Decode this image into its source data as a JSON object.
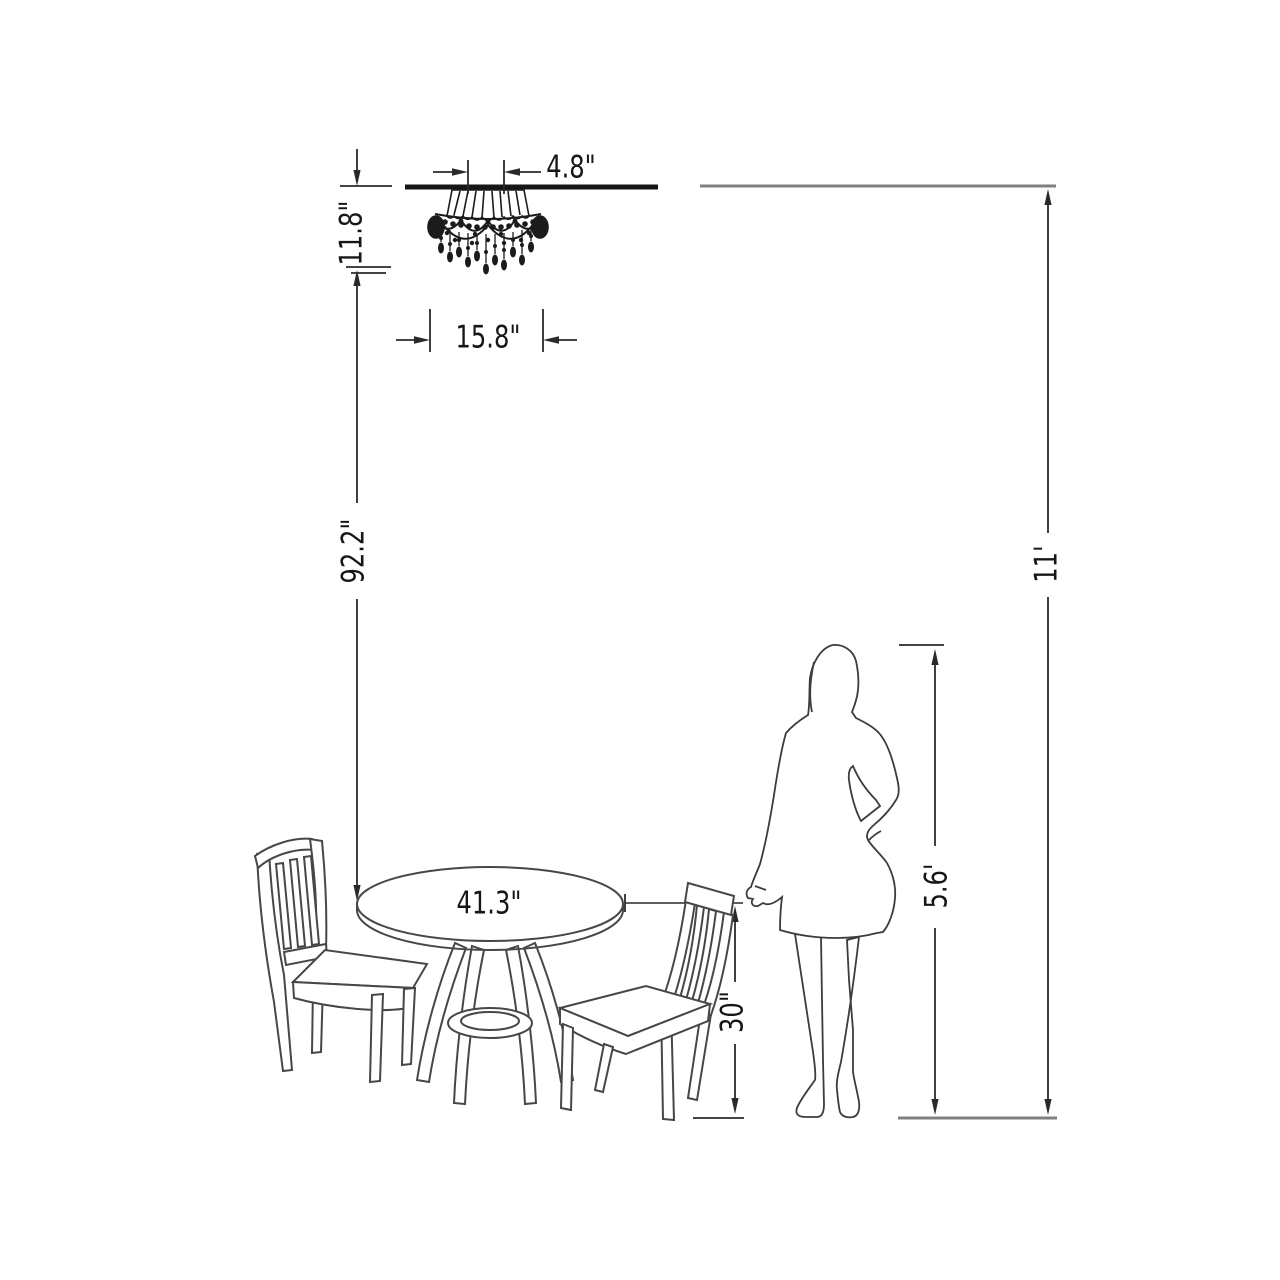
{
  "page": {
    "background": "#ffffff",
    "ink": "#2b2b2b",
    "muted_line": "#7f7f7f"
  },
  "dimension_labels": {
    "canopy_width": "4.8\"",
    "fixture_height": "11.8\"",
    "fixture_width": "15.8\"",
    "fixture_to_table": "92.2\"",
    "table_diameter": "41.3\"",
    "table_height": "30\"",
    "person_height": "5.6'",
    "ceiling_height": "11'"
  },
  "objects": {
    "chandelier": "crystal-chandelier-flush-mount",
    "table": "round-pedestal-dining-table",
    "chair_left": "slat-back-dining-chair",
    "chair_right": "slat-back-dining-chair",
    "person": "woman-silhouette",
    "ceiling": "ceiling-line",
    "floor": "floor-line"
  }
}
